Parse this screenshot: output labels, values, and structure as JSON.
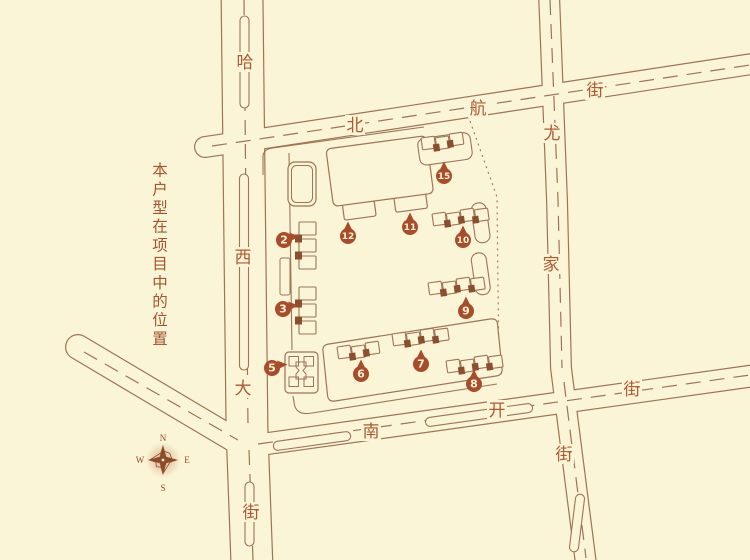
{
  "caption": {
    "text": "本户型在项目中的位置"
  },
  "compass": {
    "north": "N",
    "south": "S",
    "east": "E",
    "west": "W"
  },
  "streets": [
    {
      "name": "哈西大街",
      "labels": [
        {
          "text": "哈",
          "x": 245,
          "y": 62
        },
        {
          "text": "西",
          "x": 243,
          "y": 257
        },
        {
          "text": "大",
          "x": 243,
          "y": 388
        },
        {
          "text": "街",
          "x": 251,
          "y": 512
        }
      ]
    },
    {
      "name": "北航街",
      "labels": [
        {
          "text": "北",
          "x": 355,
          "y": 125
        },
        {
          "text": "航",
          "x": 478,
          "y": 108
        },
        {
          "text": "街",
          "x": 595,
          "y": 90
        }
      ]
    },
    {
      "name": "尤家街",
      "labels": [
        {
          "text": "尤",
          "x": 552,
          "y": 133
        },
        {
          "text": "家",
          "x": 551,
          "y": 264
        },
        {
          "text": "街",
          "x": 564,
          "y": 454
        }
      ]
    },
    {
      "name": "南开街",
      "labels": [
        {
          "text": "南",
          "x": 371,
          "y": 431
        },
        {
          "text": "开",
          "x": 497,
          "y": 410
        },
        {
          "text": "街",
          "x": 632,
          "y": 389
        }
      ]
    }
  ],
  "building_markers": [
    {
      "num": "2",
      "x": 284,
      "y": 240,
      "pointer": "right"
    },
    {
      "num": "3",
      "x": 283,
      "y": 309,
      "pointer": "right"
    },
    {
      "num": "5",
      "x": 272,
      "y": 368,
      "pointer": "right"
    },
    {
      "num": "6",
      "x": 361,
      "y": 374,
      "pointer": "up"
    },
    {
      "num": "7",
      "x": 421,
      "y": 364,
      "pointer": "up"
    },
    {
      "num": "8",
      "x": 474,
      "y": 384,
      "pointer": "up"
    },
    {
      "num": "9",
      "x": 466,
      "y": 311,
      "pointer": "up"
    },
    {
      "num": "10",
      "x": 463,
      "y": 240,
      "pointer": "up"
    },
    {
      "num": "11",
      "x": 410,
      "y": 227,
      "pointer": "up"
    },
    {
      "num": "12",
      "x": 348,
      "y": 236,
      "pointer": "up"
    },
    {
      "num": "15",
      "x": 444,
      "y": 176,
      "pointer": "up"
    }
  ],
  "colors": {
    "background": "#fbf5d7",
    "line": "#9e7356",
    "street_label": "#ad5a32",
    "marker": "#a84c29",
    "marker_text": "#fdf4d6",
    "caption": "#a4532d",
    "building_fill": "#8d4e2d",
    "compass": "#8f4a28"
  }
}
